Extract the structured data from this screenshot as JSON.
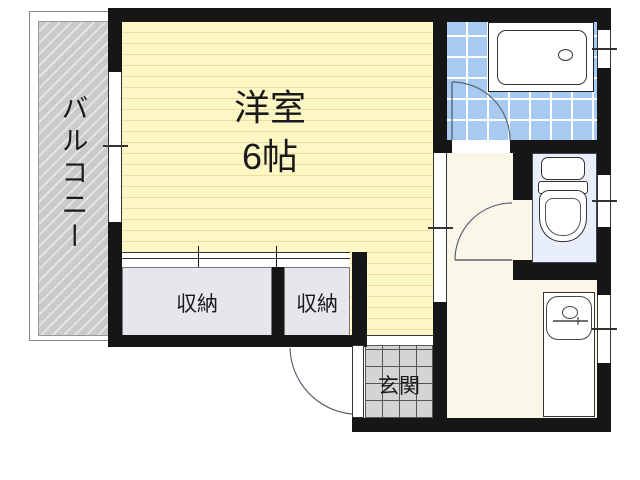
{
  "plan": {
    "balcony": {
      "label": "バルコニー"
    },
    "main_room": {
      "name_label": "洋室",
      "size_label": "6帖"
    },
    "closets": [
      {
        "label": "収納"
      },
      {
        "label": "収納"
      }
    ],
    "entrance": {
      "label": "玄関"
    },
    "fixtures": {
      "bathroom": "bathtub",
      "toilet_room": "toilet",
      "kitchen": "sink"
    }
  },
  "colors": {
    "wall": "#161616",
    "room_floor": "#fcf7c5",
    "room_stripe": "#eee0a2",
    "hallway_floor": "#faf7e8",
    "bath_tile": "#a7caf0",
    "toilet_floor": "#e9effa",
    "closet_floor": "#e9e5ed",
    "entrance_tile": "#d4d4d4",
    "balcony": "#cacaca"
  }
}
